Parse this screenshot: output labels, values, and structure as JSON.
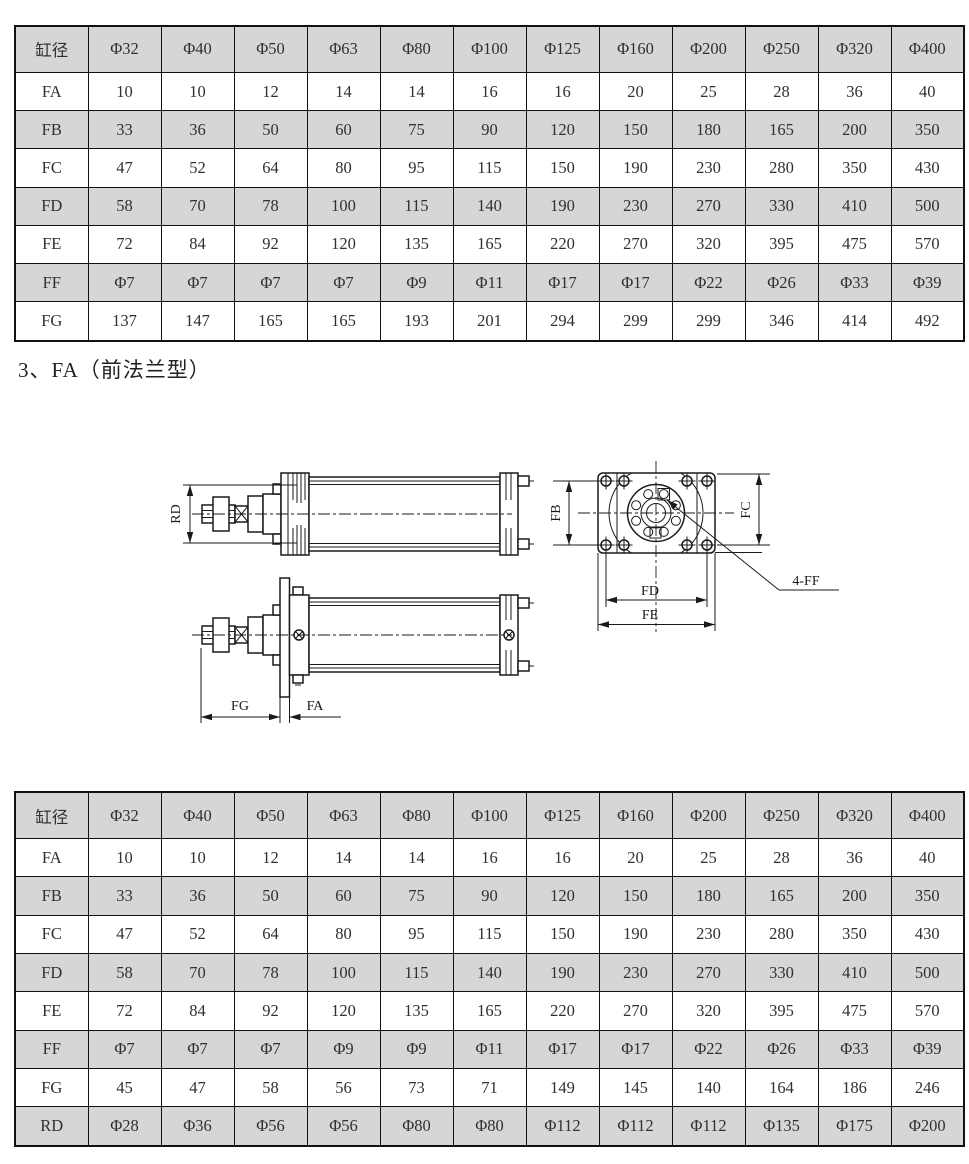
{
  "heading": "3、FA（前法兰型）",
  "colors": {
    "shade": "#d6d6d6",
    "line": "#1a1a1a",
    "text": "#303030"
  },
  "table_top": {
    "header": [
      "缸径",
      "Φ32",
      "Φ40",
      "Φ50",
      "Φ63",
      "Φ80",
      "Φ100",
      "Φ125",
      "Φ160",
      "Φ200",
      "Φ250",
      "Φ320",
      "Φ400"
    ],
    "rows": [
      [
        "FA",
        "10",
        "10",
        "12",
        "14",
        "14",
        "16",
        "16",
        "20",
        "25",
        "28",
        "36",
        "40"
      ],
      [
        "FB",
        "33",
        "36",
        "50",
        "60",
        "75",
        "90",
        "120",
        "150",
        "180",
        "165",
        "200",
        "350"
      ],
      [
        "FC",
        "47",
        "52",
        "64",
        "80",
        "95",
        "115",
        "150",
        "190",
        "230",
        "280",
        "350",
        "430"
      ],
      [
        "FD",
        "58",
        "70",
        "78",
        "100",
        "115",
        "140",
        "190",
        "230",
        "270",
        "330",
        "410",
        "500"
      ],
      [
        "FE",
        "72",
        "84",
        "92",
        "120",
        "135",
        "165",
        "220",
        "270",
        "320",
        "395",
        "475",
        "570"
      ],
      [
        "FF",
        "Φ7",
        "Φ7",
        "Φ7",
        "Φ7",
        "Φ9",
        "Φ11",
        "Φ17",
        "Φ17",
        "Φ22",
        "Φ26",
        "Φ33",
        "Φ39"
      ],
      [
        "FG",
        "137",
        "147",
        "165",
        "165",
        "193",
        "201",
        "294",
        "299",
        "299",
        "346",
        "414",
        "492"
      ]
    ]
  },
  "table_bottom": {
    "header": [
      "缸径",
      "Φ32",
      "Φ40",
      "Φ50",
      "Φ63",
      "Φ80",
      "Φ100",
      "Φ125",
      "Φ160",
      "Φ200",
      "Φ250",
      "Φ320",
      "Φ400"
    ],
    "rows": [
      [
        "FA",
        "10",
        "10",
        "12",
        "14",
        "14",
        "16",
        "16",
        "20",
        "25",
        "28",
        "36",
        "40"
      ],
      [
        "FB",
        "33",
        "36",
        "50",
        "60",
        "75",
        "90",
        "120",
        "150",
        "180",
        "165",
        "200",
        "350"
      ],
      [
        "FC",
        "47",
        "52",
        "64",
        "80",
        "95",
        "115",
        "150",
        "190",
        "230",
        "280",
        "350",
        "430"
      ],
      [
        "FD",
        "58",
        "70",
        "78",
        "100",
        "115",
        "140",
        "190",
        "230",
        "270",
        "330",
        "410",
        "500"
      ],
      [
        "FE",
        "72",
        "84",
        "92",
        "120",
        "135",
        "165",
        "220",
        "270",
        "320",
        "395",
        "475",
        "570"
      ],
      [
        "FF",
        "Φ7",
        "Φ7",
        "Φ7",
        "Φ9",
        "Φ9",
        "Φ11",
        "Φ17",
        "Φ17",
        "Φ22",
        "Φ26",
        "Φ33",
        "Φ39"
      ],
      [
        "FG",
        "45",
        "47",
        "58",
        "56",
        "73",
        "71",
        "149",
        "145",
        "140",
        "164",
        "186",
        "246"
      ],
      [
        "RD",
        "Φ28",
        "Φ36",
        "Φ56",
        "Φ56",
        "Φ80",
        "Φ80",
        "Φ112",
        "Φ112",
        "Φ112",
        "Φ135",
        "Φ175",
        "Φ200"
      ]
    ]
  },
  "drawing": {
    "labels": {
      "rd": "RD",
      "fg": "FG",
      "fa": "FA",
      "fb": "FB",
      "fc": "FC",
      "fd": "FD",
      "fe": "FE",
      "ff": "4-FF"
    }
  }
}
